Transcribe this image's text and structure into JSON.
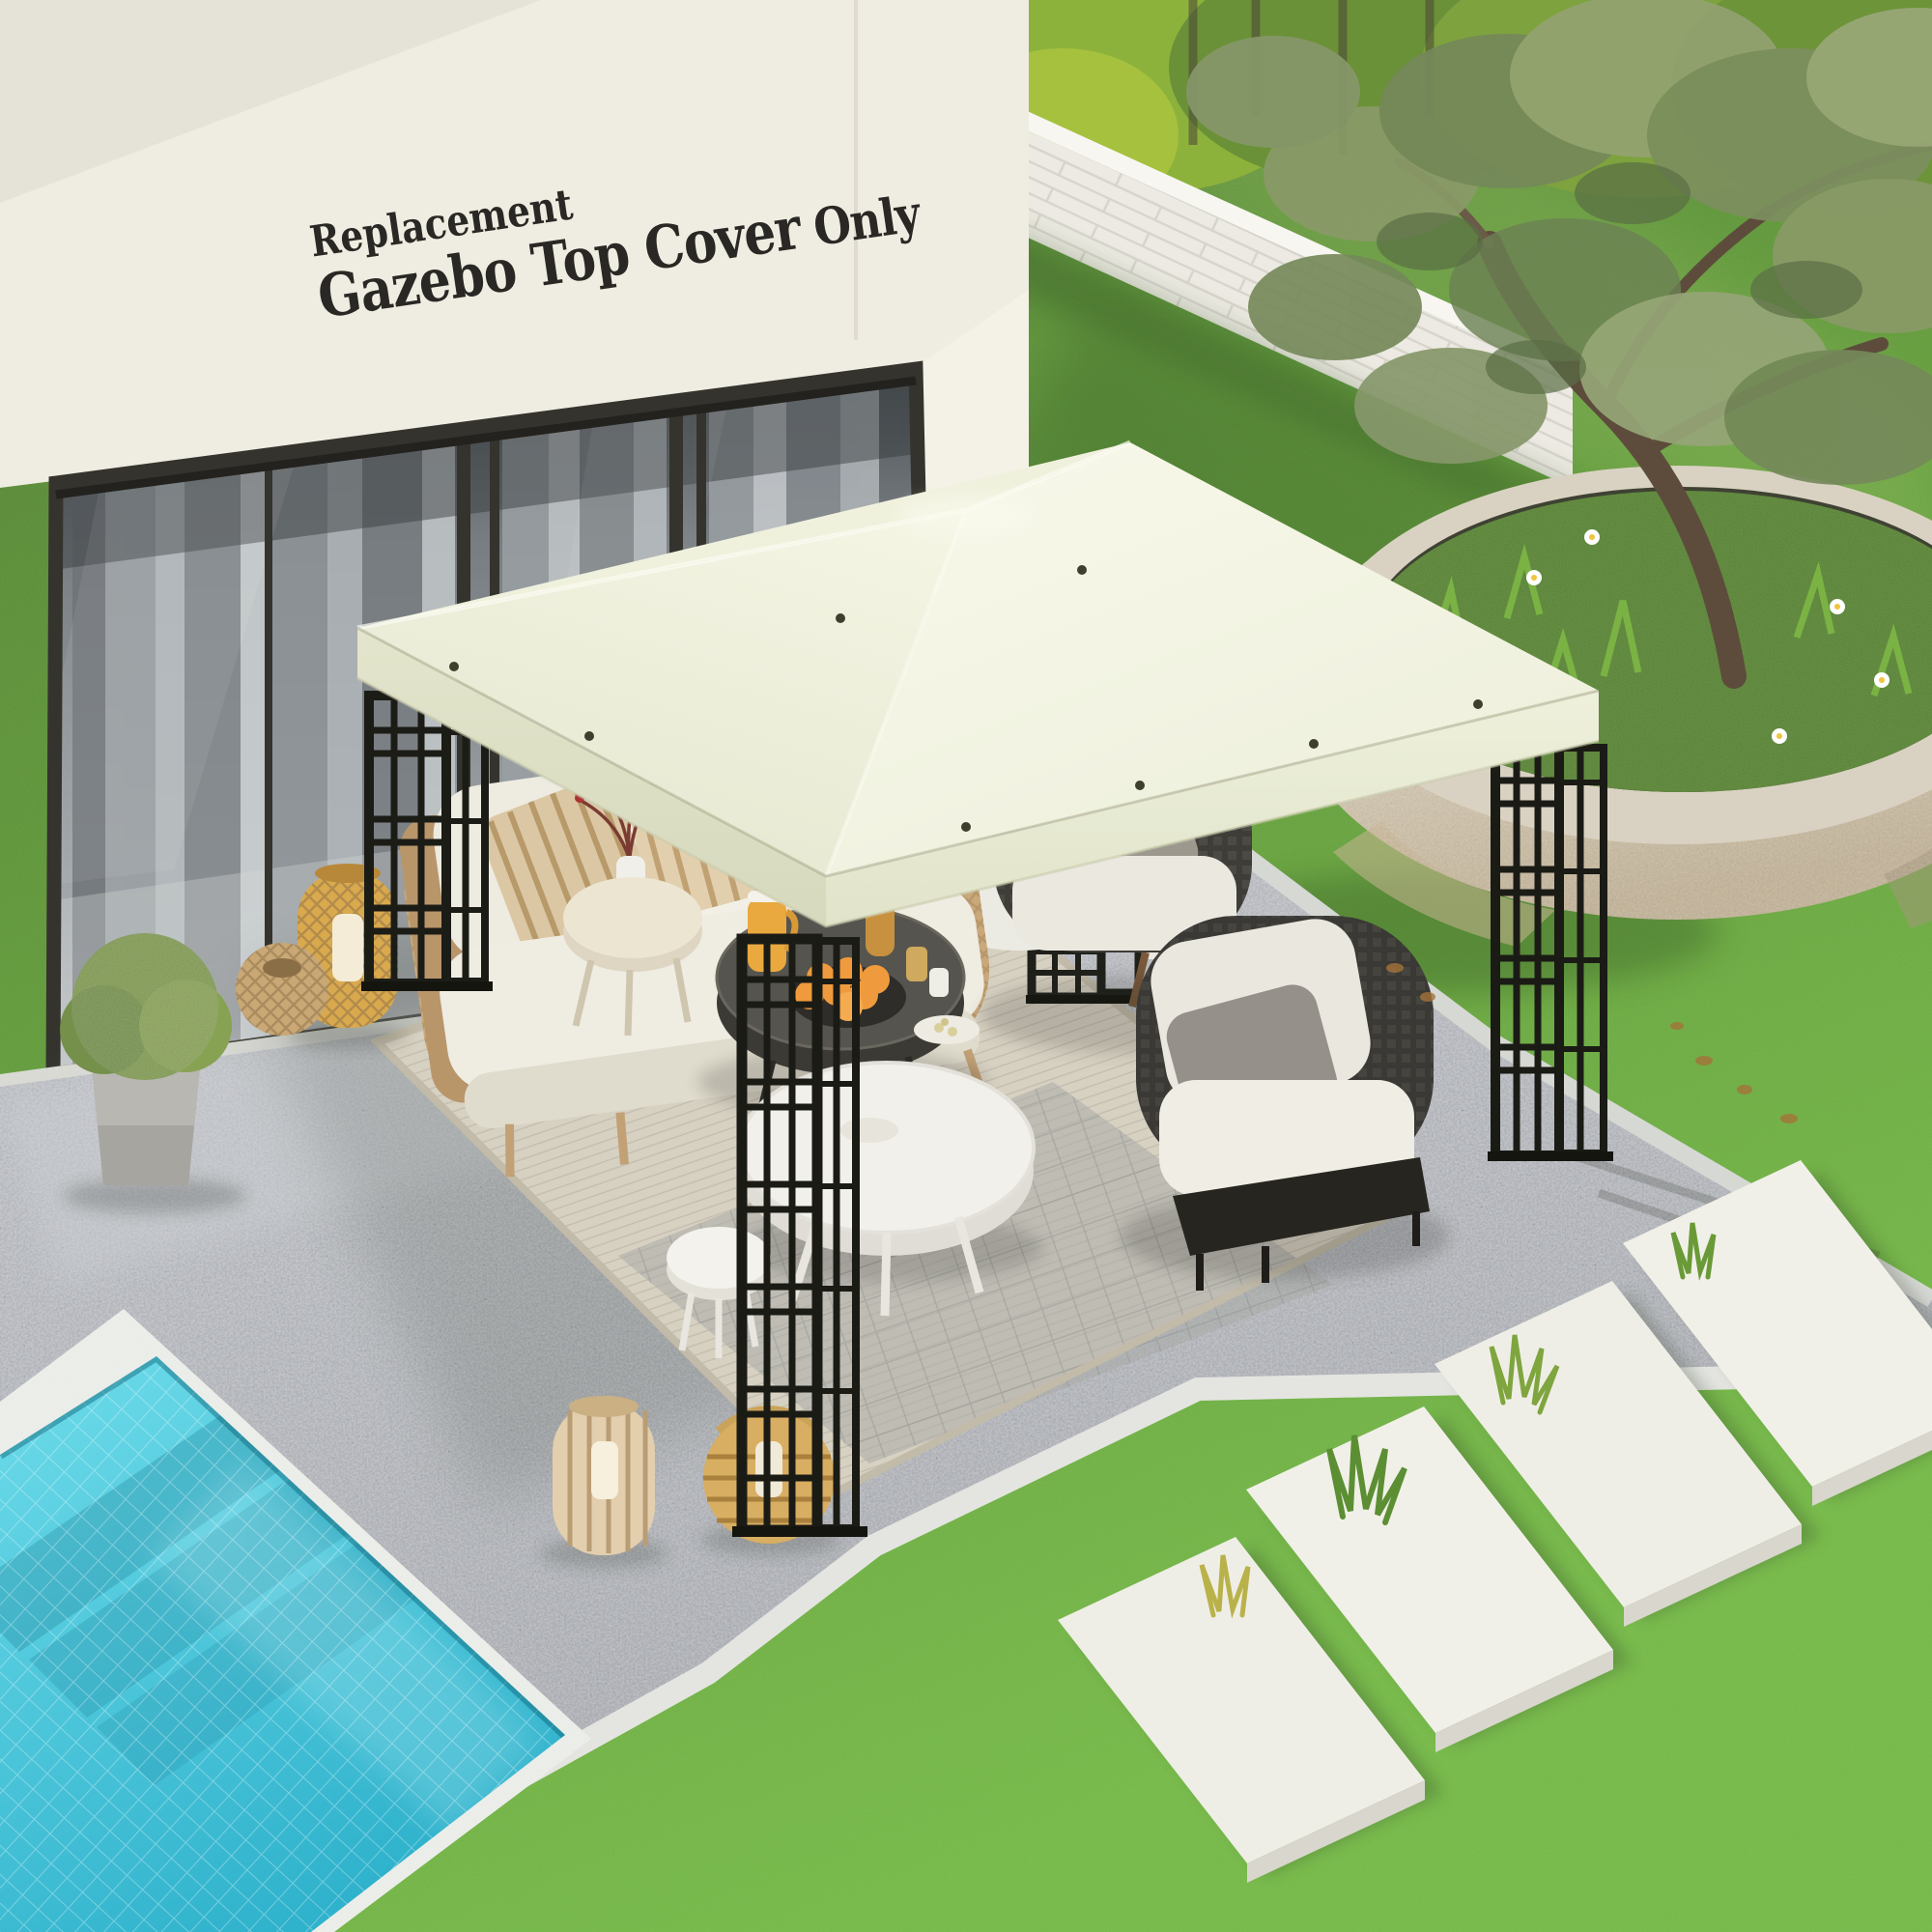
{
  "overlay_text": {
    "line1": "Replacement",
    "line2_main": "Gazebo Top Cover",
    "line2_suffix": " Only"
  },
  "palette": {
    "textDark": "#2a2824",
    "wallCream": "#efece1",
    "pillarCream": "#ece7da",
    "canopyRight": "#f5f5e6",
    "canopyLeft": "#eaecd5",
    "canopyBack": "#f0f1dd",
    "canopySkirt": "#dfe1c7",
    "frameBlack": "#1c1c17",
    "grassDark": "#4e7c33",
    "grassLight": "#6fb13c",
    "gravel": "#b5b8bd",
    "poolWater": "#45c3da",
    "poolCoping": "#eef0ec",
    "brickWall": "#eceae2",
    "rugBeige": "#d7d1c2",
    "rattan": "#c9a87a",
    "orangeFruit": "#ef9b3d",
    "stonePlanter": "#d9cdb6"
  },
  "scene_objects": [
    "house-wall",
    "sliding-glass-doors",
    "sheer-curtains",
    "gazebo-canopy-top",
    "gazebo-lattice-posts",
    "outdoor-sofa",
    "striped-pillows",
    "wicker-chair",
    "lounge-chairs",
    "coffee-table-dark",
    "coffee-table-white",
    "side-table",
    "orange-fruit-bowl",
    "drink-pitcher",
    "rattan-lanterns",
    "boxwood-planter",
    "area-rug",
    "gravel-patio",
    "swimming-pool",
    "lawn",
    "garden-brick-wall",
    "olive-tree",
    "round-stone-planter",
    "stepping-stones"
  ]
}
